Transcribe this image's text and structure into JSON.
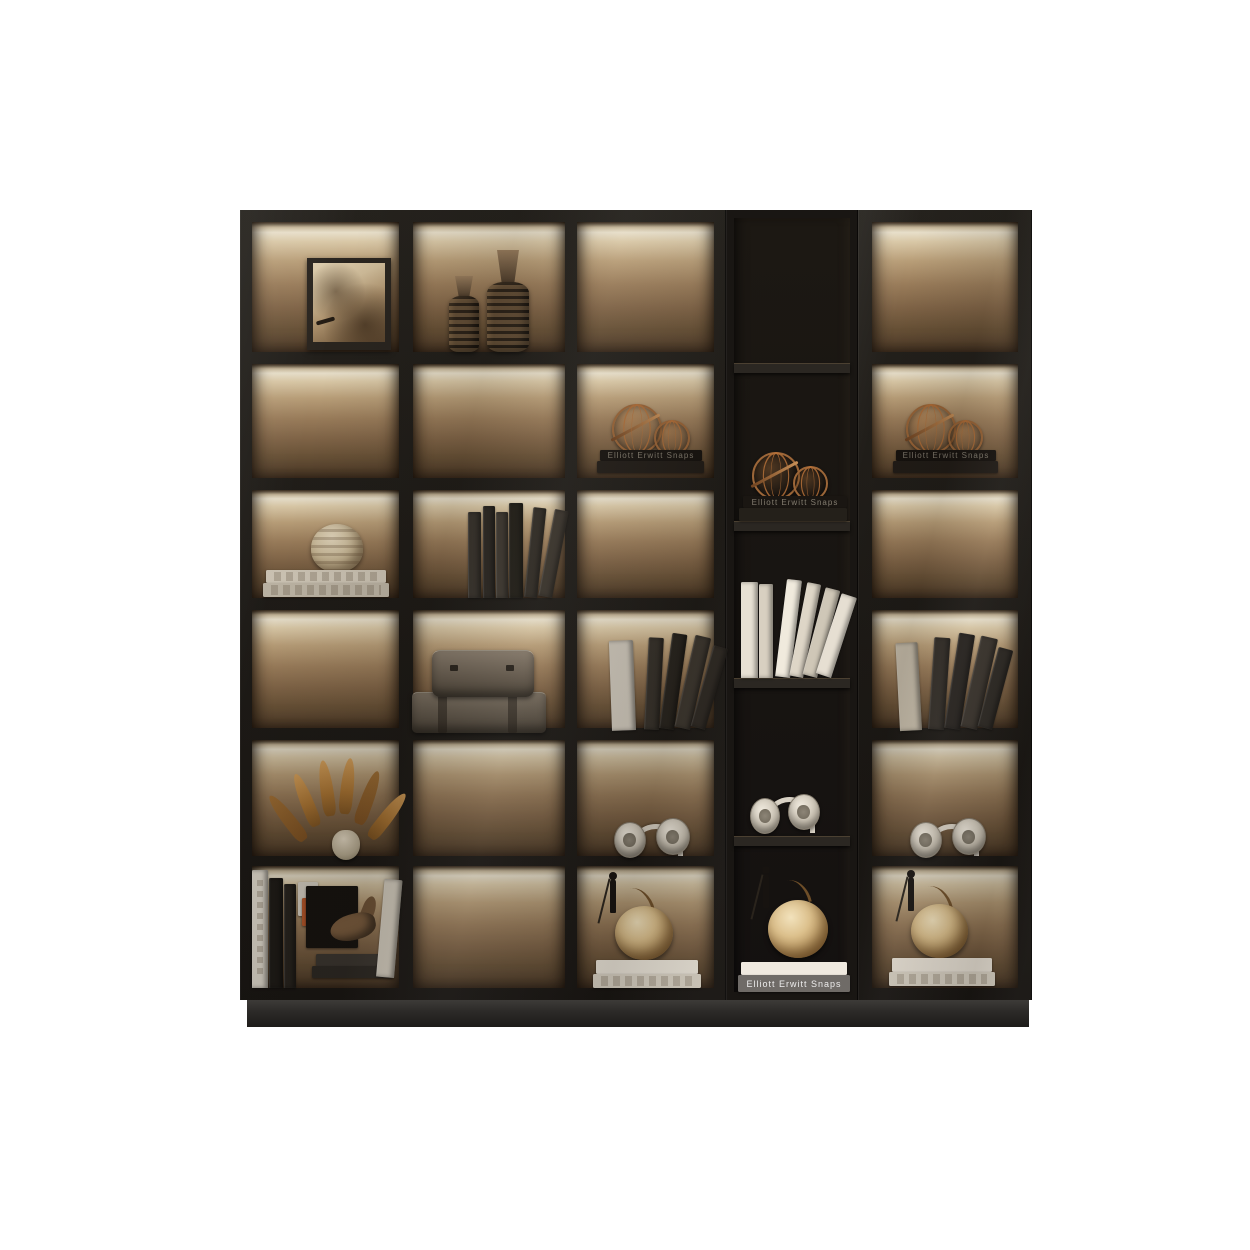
{
  "image": {
    "type": "product-photo",
    "subject": "Modern black display bookcase with glass doors, LED backlit shelves, an open center bay and decorative styling objects",
    "background": "#ffffff"
  },
  "palette": {
    "frame": "#201d19",
    "frame_dark": "#14110e",
    "backlight_bright": "#f5ecd6",
    "backlight_mid": "#a2835f",
    "backlight_deep": "#5b4530",
    "open_bay": "#16130f",
    "plinth": "#2b2927",
    "copper": "#9c6638",
    "cream": "#d9d2c5"
  },
  "cabinet": {
    "left_unit": {
      "type": "glass-door display unit",
      "columns": 3,
      "rows": 6
    },
    "center_unit": {
      "type": "open shelf bay",
      "shelves": 5
    },
    "right_unit": {
      "type": "glass-door display unit",
      "columns": 1,
      "rows": 6
    },
    "lighting": "LED strip under each shelf"
  },
  "decor": {
    "book_spine_title": "Elliott Erwitt Snaps",
    "items": [
      "framed portrait",
      "ribbed bottle vases",
      "copper wire spheres on books",
      "ribbed round vase on books",
      "row of dark books",
      "stacked vintage cases",
      "leaning books",
      "white books",
      "dried pampas in vase",
      "headphones",
      "apple sculpture with figurine on books",
      "book pile with horse sculpture"
    ]
  }
}
